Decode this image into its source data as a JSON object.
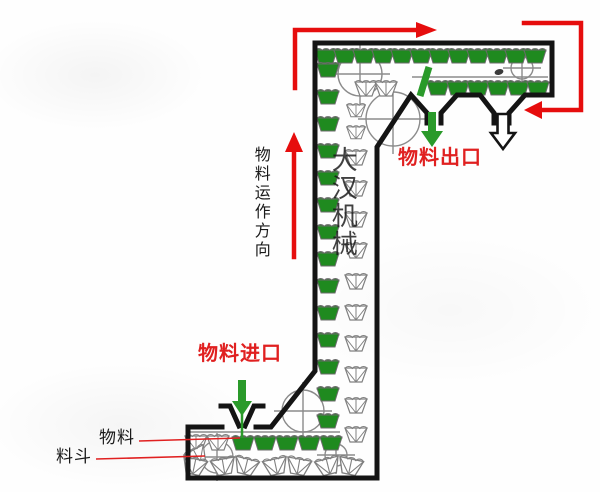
{
  "title": "Z型斗式提升机物料流向示意图",
  "labels": {
    "outlet": "物料出口",
    "inlet": "物料进口",
    "flow_direction": "物料运作方向",
    "material": "物料",
    "bucket": "料斗",
    "watermark": "大汉机械"
  },
  "colors": {
    "label_red": "#e02020",
    "arrow_red": "#e60d0d",
    "bucket_green": "#1f8a1f",
    "arrow_green": "#2a9a2a",
    "machine_outline": "#141414",
    "mechanism_gray": "#8b8b8b"
  },
  "icons": [
    {
      "name": "flow-arrow-top-left",
      "meaning": "belt travels right along top section"
    },
    {
      "name": "flow-arrow-top-right",
      "meaning": "belt returns left into head section"
    },
    {
      "name": "flow-arrow-up",
      "meaning": "material travels upward in vertical section"
    },
    {
      "name": "outlet-arrow-green",
      "meaning": "material discharge at outlet 1"
    },
    {
      "name": "outlet-arrow-outline",
      "meaning": "material discharge at outlet 2"
    },
    {
      "name": "inlet-arrow-green",
      "meaning": "material fed into inlet hopper"
    }
  ],
  "diagram": {
    "type": "bucket-elevator-z-shape",
    "sections": [
      "bottom horizontal feed section",
      "vertical lift section",
      "top horizontal discharge section"
    ],
    "outlet_count": 2,
    "full_bucket_note": "green filled buckets carry material",
    "empty_bucket_note": "outlined buckets return empty"
  }
}
